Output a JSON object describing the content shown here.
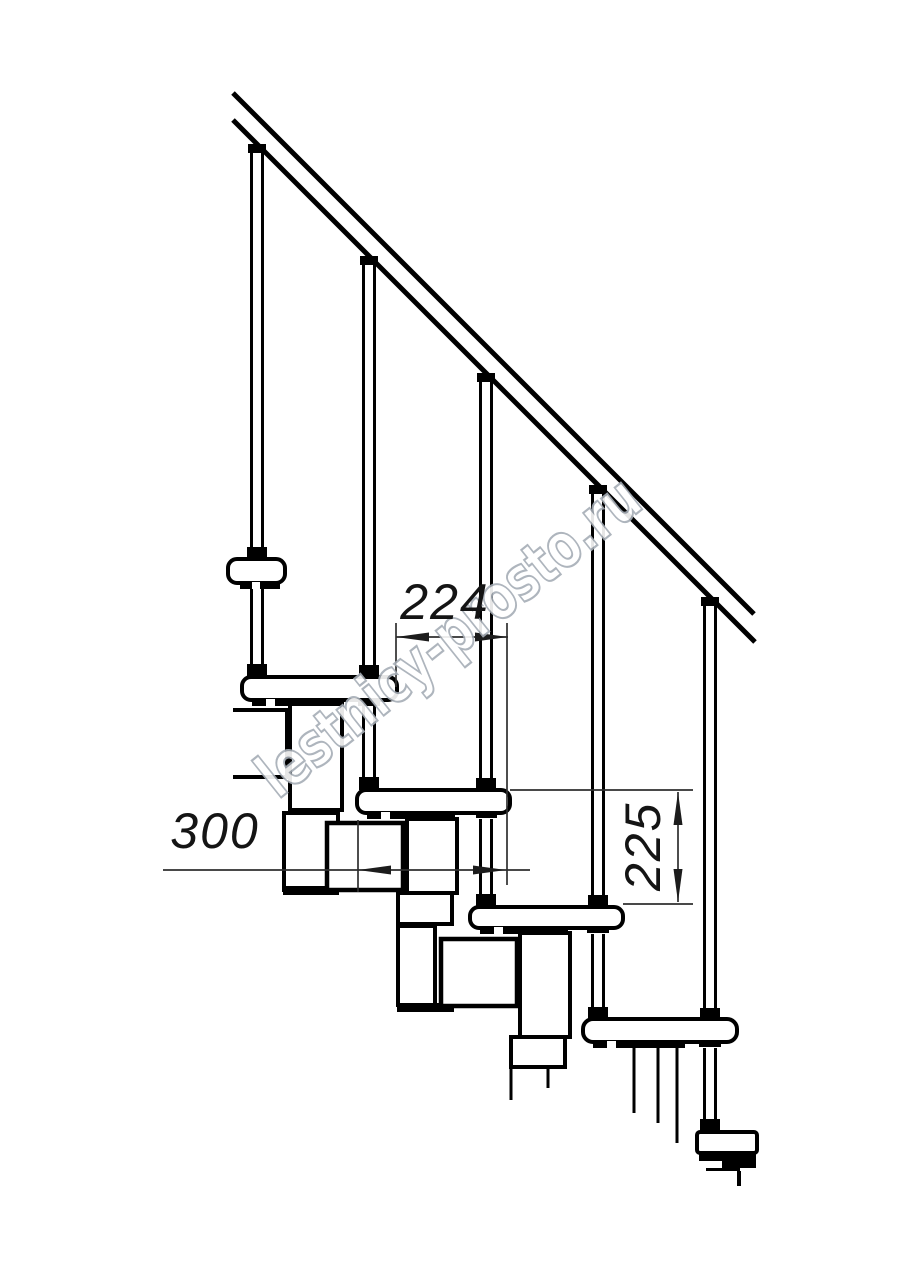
{
  "drawing": {
    "watermark": "lestnicy-prosto.ru",
    "dimensions": {
      "run": "224",
      "depth": "300",
      "riser": "225"
    }
  },
  "colors": {
    "background": "#ffffff",
    "line": "#000000",
    "dimension": "#2f2f2f",
    "watermark_stroke": "#a6adb6",
    "watermark_fill": "#ffffff"
  }
}
